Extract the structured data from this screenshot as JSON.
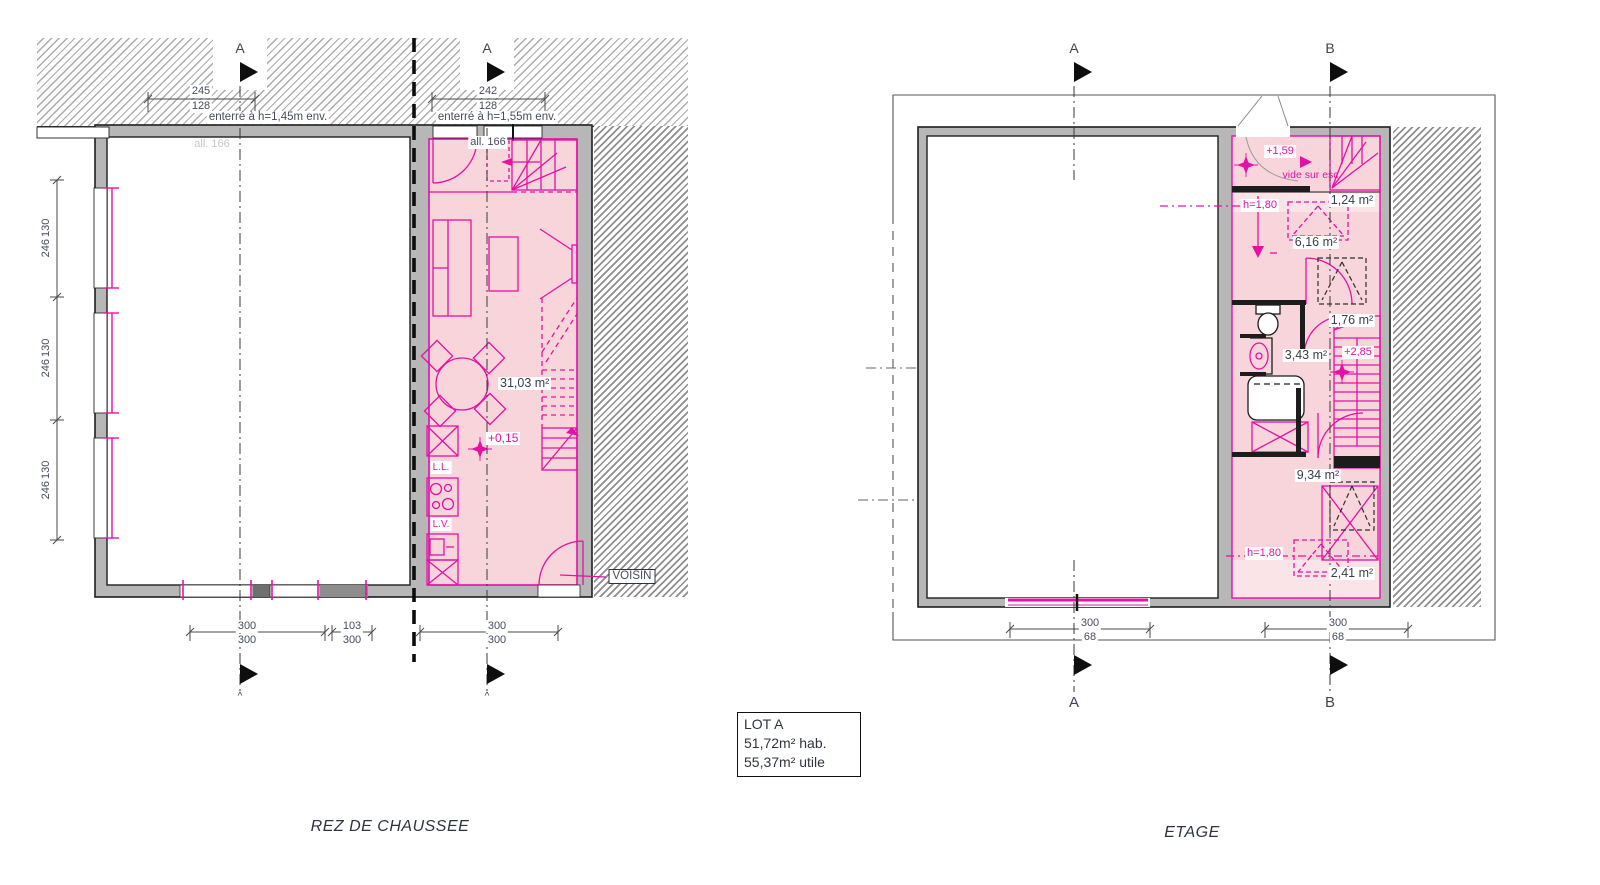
{
  "titles": {
    "ground": "REZ DE CHAUSSEE",
    "upper": "ETAGE"
  },
  "lot": {
    "name": "LOT A",
    "hab": "51,72m² hab.",
    "utile": "55,37m² utile"
  },
  "markers": {
    "a": "A",
    "b": "B",
    "caret": "^"
  },
  "colors": {
    "magenta": "#e610a5",
    "pink": "#f8d5da",
    "pink_light": "#fbe4e8",
    "wall_gray": "#b7b7b7"
  },
  "ground": {
    "dim_top_left": {
      "top": "245",
      "bottom": "128"
    },
    "dim_top_right": {
      "top": "242",
      "bottom": "128"
    },
    "buried_left": "enterré à h=1,45m env.",
    "buried_right": "enterré à h=1,55m env.",
    "sill": "all. 166",
    "sill_faint": "all. 166",
    "side_dim": {
      "top": "246",
      "bottom": "130"
    },
    "area_living": "31,03 m²",
    "level": "+0,15",
    "washer": "L.L.",
    "dishwasher": "L.V.",
    "neighbor": "VOISIN",
    "dims_bottom": [
      {
        "top": "300",
        "bottom": "300"
      },
      {
        "top": "103",
        "bottom": "300"
      },
      {
        "top": "300",
        "bottom": "300"
      }
    ]
  },
  "upper": {
    "level_landing": "+1,59",
    "void_label": "vide sur esc.",
    "area_closet_top": "1,24 m²",
    "height_top": "h=1,80",
    "area_room_top": "6,16 m²",
    "area_landing": "1,76 m²",
    "area_bath": "3,43 m²",
    "level_floor": "+2,85",
    "area_bedroom": "9,34 m²",
    "height_bottom": "h=1,80",
    "area_closet_bottom": "2,41 m²",
    "dims_bottom": [
      {
        "top": "300",
        "bottom": "68"
      },
      {
        "top": "300",
        "bottom": "68"
      }
    ]
  }
}
